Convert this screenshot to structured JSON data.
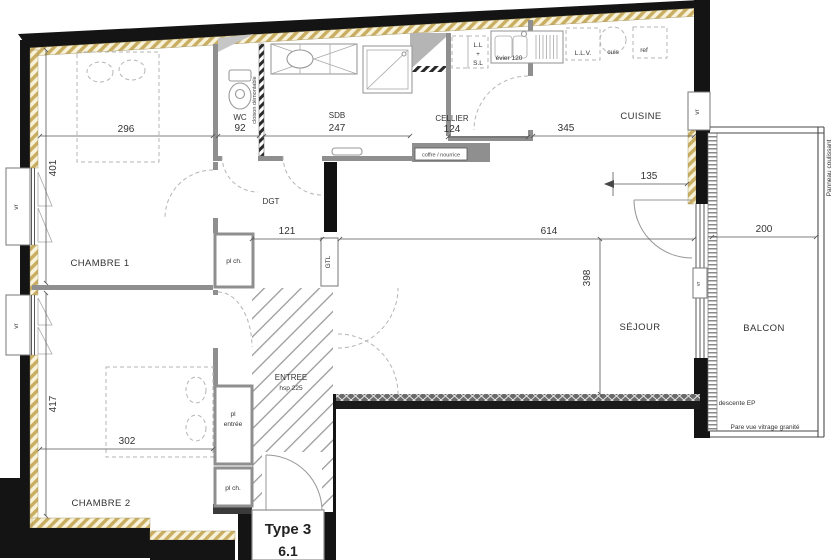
{
  "plan": {
    "type_label": "Type 3",
    "lot_number": "6.1",
    "rooms": {
      "chambre1": {
        "name": "CHAMBRE 1",
        "width": "296",
        "depth": "401"
      },
      "chambre2": {
        "name": "CHAMBRE 2",
        "width": "302",
        "depth": "417"
      },
      "wc": {
        "name": "WC",
        "width": "92"
      },
      "sdb": {
        "name": "SDB",
        "width": "247"
      },
      "cellier": {
        "name": "CELLIER",
        "width": "124"
      },
      "cuisine": {
        "name": "CUISINE",
        "width": "345"
      },
      "dgt": {
        "name": "DGT",
        "width": "121"
      },
      "entree": {
        "name": "ENTREE",
        "ceiling": "hsp 225"
      },
      "sejour": {
        "name": "SÉJOUR",
        "width": "614",
        "depth": "398",
        "door_offset": "135"
      },
      "balcon": {
        "name": "BALCON",
        "width": "200"
      }
    },
    "labels": {
      "gtl": "GTL",
      "closet_small": "pl ch.",
      "closet_entree_line1": "pl",
      "closet_entree_line2": "entrée",
      "cloison_demontable": "cloison démontable",
      "coffre_nourrice": "coffre / nourrice",
      "lave_linge": "L.L",
      "plus": "+",
      "seche_linge": "S.L",
      "evier": "évier 120",
      "lave_vaisselle": "L.L.V.",
      "cuisson": "cuis",
      "refrigerateur": "ref",
      "volet_roulant": "vr",
      "descente_ep": "descente EP",
      "pare_vue": "Pare vue vitrage granité",
      "panneau_coulissant": "Panneau coulissant"
    },
    "colors": {
      "wall": "#141414",
      "insulation_hatch": "#c9ae62",
      "partition": "#8f8f8f",
      "background": "#ffffff"
    }
  }
}
